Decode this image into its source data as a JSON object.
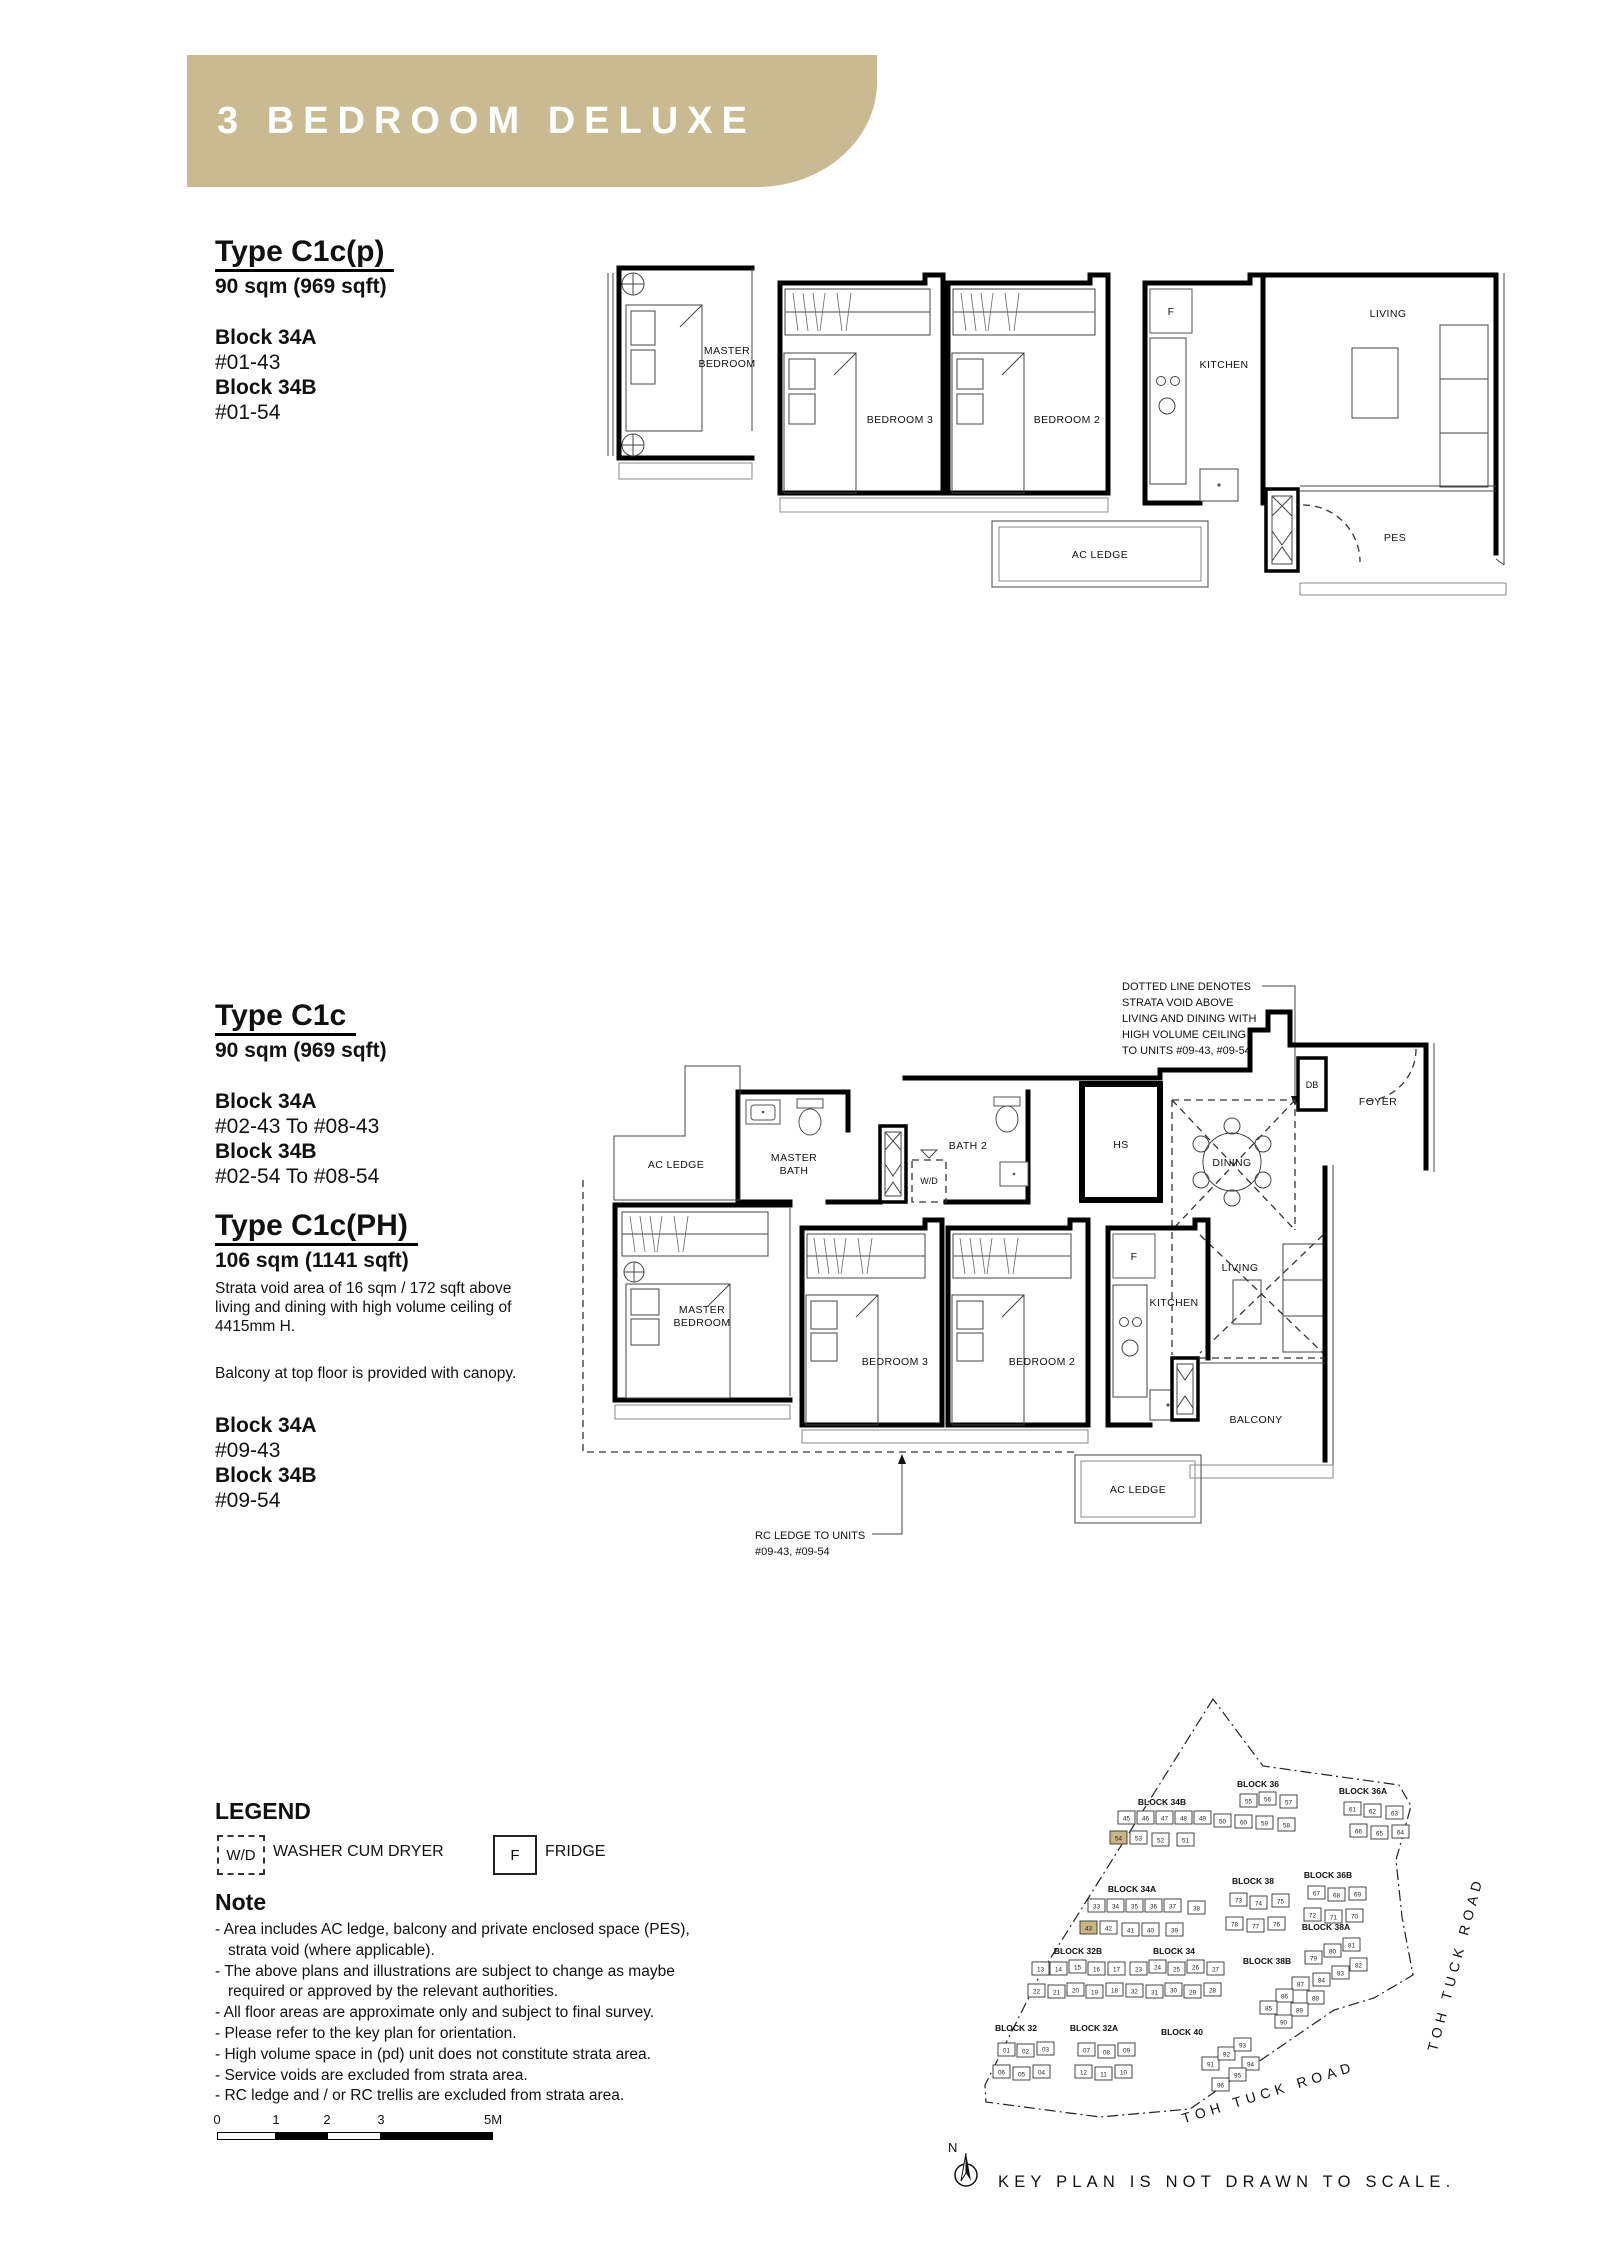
{
  "banner": {
    "title": "3 BEDROOM DELUXE",
    "color": "#c9ba92"
  },
  "types": {
    "c1cp": {
      "title": "Type C1c(p)",
      "area": "90 sqm (969 sqft)",
      "blocks": [
        {
          "name": "Block 34A",
          "units": "#01-43"
        },
        {
          "name": "Block 34B",
          "units": "#01-54"
        }
      ]
    },
    "c1c": {
      "title": "Type C1c",
      "area": "90 sqm (969 sqft)",
      "blocks": [
        {
          "name": "Block 34A",
          "units": "#02-43 To #08-43"
        },
        {
          "name": "Block 34B",
          "units": "#02-54 To #08-54"
        }
      ]
    },
    "c1cph": {
      "title": "Type C1c(PH)",
      "area": "106 sqm (1141 sqft)",
      "note1": "Strata void area of 16 sqm / 172 sqft above living and dining with high volume ceiling of 4415mm H.",
      "note2": "Balcony at top floor is provided with canopy.",
      "blocks": [
        {
          "name": "Block 34A",
          "units": "#09-43"
        },
        {
          "name": "Block 34B",
          "units": "#09-54"
        }
      ]
    }
  },
  "plan1": {
    "master_bedroom": [
      "MASTER",
      "BEDROOM"
    ],
    "bedroom3": "BEDROOM 3",
    "bedroom2": "BEDROOM 2",
    "kitchen": "KITCHEN",
    "fridge": "F",
    "living": "LIVING",
    "pes": "PES",
    "ac_ledge": "AC LEDGE"
  },
  "plan2": {
    "void_note": [
      "DOTTED LINE DENOTES",
      "STRATA VOID ABOVE",
      "LIVING AND DINING WITH",
      "HIGH VOLUME CEILING",
      "TO UNITS #09-43, #09-54"
    ],
    "rc_note": [
      "RC LEDGE TO UNITS",
      "#09-43, #09-54"
    ],
    "ac_ledge": "AC LEDGE",
    "master_bath": [
      "MASTER",
      "BATH"
    ],
    "wd": "W/D",
    "bath2": "BATH 2",
    "hs": "HS",
    "dining": "DINING",
    "db": "DB",
    "foyer": "FOYER",
    "master_bedroom": [
      "MASTER",
      "BEDROOM"
    ],
    "bedroom3": "BEDROOM 3",
    "bedroom2": "BEDROOM 2",
    "kitchen": "KITCHEN",
    "fridge": "F",
    "living": "LIVING",
    "balcony": "BALCONY"
  },
  "legend": {
    "title": "LEGEND",
    "wd_symbol": "W/D",
    "wd_label": "WASHER CUM DRYER",
    "f_symbol": "F",
    "f_label": "FRIDGE"
  },
  "note": {
    "title": "Note",
    "items": [
      {
        "t": "- Area includes AC ledge, balcony and private enclosed space (PES),"
      },
      {
        "t": "strata void (where applicable)."
      },
      {
        "t": "- The above plans and illustrations are subject to change as maybe"
      },
      {
        "t": "required or approved by the relevant authorities."
      },
      {
        "t": "- All floor areas are approximate only and subject to final survey."
      },
      {
        "t": "- Please refer to the key plan for orientation."
      },
      {
        "t": "- High volume space in (pd) unit does not constitute strata area."
      },
      {
        "t": "- Service voids are excluded from strata area."
      },
      {
        "t": "- RC ledge and / or RC trellis are excluded from strata area."
      }
    ]
  },
  "scalebar": {
    "ticks": [
      "0",
      "1",
      "2",
      "3",
      "5M"
    ]
  },
  "keyplan": {
    "north": "N",
    "footer": "KEY PLAN IS NOT DRAWN TO SCALE.",
    "road_right": "TOH TUCK ROAD",
    "road_bottom": "TOH TUCK ROAD",
    "highlight_color": "#c9b583",
    "blocks": [
      {
        "label": "BLOCK 34B",
        "lx": 222,
        "ly": 140,
        "units": [
          {
            "n": "45",
            "x": 178,
            "y": 146
          },
          {
            "n": "46",
            "x": 197,
            "y": 146
          },
          {
            "n": "47",
            "x": 216,
            "y": 146
          },
          {
            "n": "48",
            "x": 235,
            "y": 146
          },
          {
            "n": "49",
            "x": 254,
            "y": 146
          },
          {
            "n": "50",
            "x": 274,
            "y": 149
          },
          {
            "n": "54",
            "x": 170,
            "y": 166,
            "hl": true
          },
          {
            "n": "53",
            "x": 190,
            "y": 166
          },
          {
            "n": "52",
            "x": 212,
            "y": 168
          },
          {
            "n": "51",
            "x": 237,
            "y": 168
          }
        ]
      },
      {
        "label": "BLOCK 36",
        "lx": 318,
        "ly": 122,
        "units": [
          {
            "n": "55",
            "x": 300,
            "y": 129
          },
          {
            "n": "56",
            "x": 319,
            "y": 127
          },
          {
            "n": "57",
            "x": 340,
            "y": 130
          },
          {
            "n": "60",
            "x": 295,
            "y": 150
          },
          {
            "n": "59",
            "x": 316,
            "y": 151
          },
          {
            "n": "58",
            "x": 338,
            "y": 153
          }
        ]
      },
      {
        "label": "BLOCK 36A",
        "lx": 423,
        "ly": 129,
        "units": [
          {
            "n": "61",
            "x": 404,
            "y": 137
          },
          {
            "n": "62",
            "x": 424,
            "y": 139
          },
          {
            "n": "63",
            "x": 446,
            "y": 141
          },
          {
            "n": "66",
            "x": 410,
            "y": 159
          },
          {
            "n": "65",
            "x": 431,
            "y": 161
          },
          {
            "n": "64",
            "x": 452,
            "y": 160
          }
        ]
      },
      {
        "label": "BLOCK 34A",
        "lx": 192,
        "ly": 227,
        "units": [
          {
            "n": "33",
            "x": 148,
            "y": 234
          },
          {
            "n": "34",
            "x": 167,
            "y": 234
          },
          {
            "n": "35",
            "x": 186,
            "y": 234
          },
          {
            "n": "36",
            "x": 205,
            "y": 234
          },
          {
            "n": "37",
            "x": 224,
            "y": 234
          },
          {
            "n": "38",
            "x": 248,
            "y": 236
          },
          {
            "n": "43",
            "x": 140,
            "y": 256,
            "hl": true
          },
          {
            "n": "42",
            "x": 160,
            "y": 256
          },
          {
            "n": "41",
            "x": 182,
            "y": 258
          },
          {
            "n": "40",
            "x": 202,
            "y": 258
          },
          {
            "n": "39",
            "x": 226,
            "y": 258
          }
        ]
      },
      {
        "label": "BLOCK 38",
        "lx": 313,
        "ly": 219,
        "units": [
          {
            "n": "73",
            "x": 290,
            "y": 228
          },
          {
            "n": "74",
            "x": 310,
            "y": 231
          },
          {
            "n": "75",
            "x": 332,
            "y": 229
          },
          {
            "n": "78",
            "x": 286,
            "y": 252
          },
          {
            "n": "77",
            "x": 307,
            "y": 254
          },
          {
            "n": "76",
            "x": 328,
            "y": 252
          }
        ]
      },
      {
        "label": "BLOCK 36B",
        "lx": 388,
        "ly": 213,
        "units": [
          {
            "n": "67",
            "x": 368,
            "y": 221
          },
          {
            "n": "68",
            "x": 388,
            "y": 223
          },
          {
            "n": "69",
            "x": 409,
            "y": 222
          },
          {
            "n": "72",
            "x": 364,
            "y": 243
          },
          {
            "n": "71",
            "x": 385,
            "y": 245
          },
          {
            "n": "70",
            "x": 406,
            "y": 244
          }
        ]
      },
      {
        "label": "BLOCK 38A",
        "lx": 386,
        "ly": 265,
        "units": [
          {
            "n": "79",
            "x": 365,
            "y": 286
          },
          {
            "n": "80",
            "x": 384,
            "y": 279
          },
          {
            "n": "81",
            "x": 403,
            "y": 273
          },
          {
            "n": "84",
            "x": 373,
            "y": 308
          },
          {
            "n": "83",
            "x": 392,
            "y": 301
          },
          {
            "n": "82",
            "x": 410,
            "y": 293
          }
        ]
      },
      {
        "label": "BLOCK 32B",
        "lx": 138,
        "ly": 289,
        "units": [
          {
            "n": "13",
            "x": 92,
            "y": 297
          },
          {
            "n": "14",
            "x": 110,
            "y": 297
          },
          {
            "n": "15",
            "x": 129,
            "y": 295
          },
          {
            "n": "16",
            "x": 148,
            "y": 297
          },
          {
            "n": "17",
            "x": 168,
            "y": 297
          },
          {
            "n": "22",
            "x": 88,
            "y": 319
          },
          {
            "n": "21",
            "x": 108,
            "y": 320
          },
          {
            "n": "20",
            "x": 127,
            "y": 318
          },
          {
            "n": "19",
            "x": 146,
            "y": 320
          },
          {
            "n": "18",
            "x": 166,
            "y": 318
          }
        ]
      },
      {
        "label": "BLOCK 34",
        "lx": 234,
        "ly": 289,
        "units": [
          {
            "n": "23",
            "x": 190,
            "y": 297
          },
          {
            "n": "24",
            "x": 209,
            "y": 295
          },
          {
            "n": "25",
            "x": 228,
            "y": 297
          },
          {
            "n": "26",
            "x": 247,
            "y": 295
          },
          {
            "n": "27",
            "x": 267,
            "y": 297
          },
          {
            "n": "32",
            "x": 186,
            "y": 319
          },
          {
            "n": "31",
            "x": 206,
            "y": 320
          },
          {
            "n": "30",
            "x": 225,
            "y": 318
          },
          {
            "n": "29",
            "x": 244,
            "y": 320
          },
          {
            "n": "28",
            "x": 264,
            "y": 318
          }
        ]
      },
      {
        "label": "BLOCK 38B",
        "lx": 327,
        "ly": 299,
        "units": [
          {
            "n": "87",
            "x": 352,
            "y": 312
          },
          {
            "n": "86",
            "x": 336,
            "y": 324
          },
          {
            "n": "85",
            "x": 320,
            "y": 336
          },
          {
            "n": "88",
            "x": 367,
            "y": 326
          },
          {
            "n": "89",
            "x": 351,
            "y": 338
          },
          {
            "n": "90",
            "x": 335,
            "y": 350
          }
        ]
      },
      {
        "label": "BLOCK 32",
        "lx": 76,
        "ly": 366,
        "units": [
          {
            "n": "01",
            "x": 58,
            "y": 378
          },
          {
            "n": "02",
            "x": 77,
            "y": 379
          },
          {
            "n": "03",
            "x": 97,
            "y": 377
          },
          {
            "n": "06",
            "x": 53,
            "y": 400
          },
          {
            "n": "05",
            "x": 73,
            "y": 402
          },
          {
            "n": "04",
            "x": 93,
            "y": 400
          }
        ]
      },
      {
        "label": "BLOCK 32A",
        "lx": 154,
        "ly": 366,
        "units": [
          {
            "n": "07",
            "x": 138,
            "y": 378
          },
          {
            "n": "08",
            "x": 158,
            "y": 380
          },
          {
            "n": "09",
            "x": 178,
            "y": 378
          },
          {
            "n": "12",
            "x": 135,
            "y": 400
          },
          {
            "n": "11",
            "x": 155,
            "y": 402
          },
          {
            "n": "10",
            "x": 175,
            "y": 400
          }
        ]
      },
      {
        "label": "BLOCK 40",
        "lx": 242,
        "ly": 370,
        "units": [
          {
            "n": "91",
            "x": 262,
            "y": 392
          },
          {
            "n": "92",
            "x": 278,
            "y": 382
          },
          {
            "n": "93",
            "x": 294,
            "y": 373
          },
          {
            "n": "94",
            "x": 302,
            "y": 392
          },
          {
            "n": "95",
            "x": 289,
            "y": 403
          },
          {
            "n": "96",
            "x": 272,
            "y": 413
          }
        ]
      }
    ]
  }
}
